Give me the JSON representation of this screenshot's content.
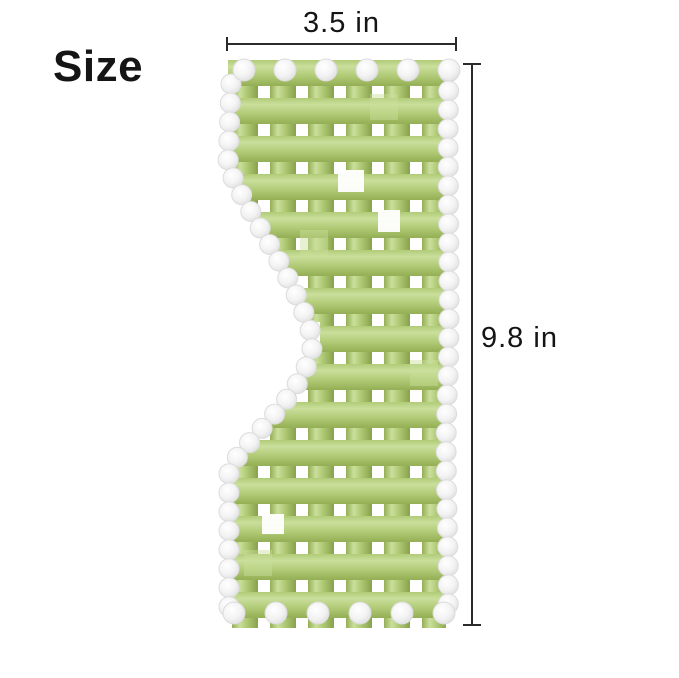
{
  "labels": {
    "size": "Size",
    "width": "3.5 in",
    "height": "9.8 in"
  },
  "illustration": {
    "description": "Green woven jade-stone mask panel with white crystal bead edging and an S-curved left edge",
    "colors": {
      "jade_mid": "#b1cb77",
      "jade_light": "#cadf9c",
      "jade_dark": "#94ae55",
      "jade_deep": "#87a24b",
      "bead_fill": "#f3f3f3",
      "bead_stroke": "#dcdcdc",
      "line": "#2b2b2b",
      "text": "#151515",
      "background": "#ffffff"
    }
  }
}
